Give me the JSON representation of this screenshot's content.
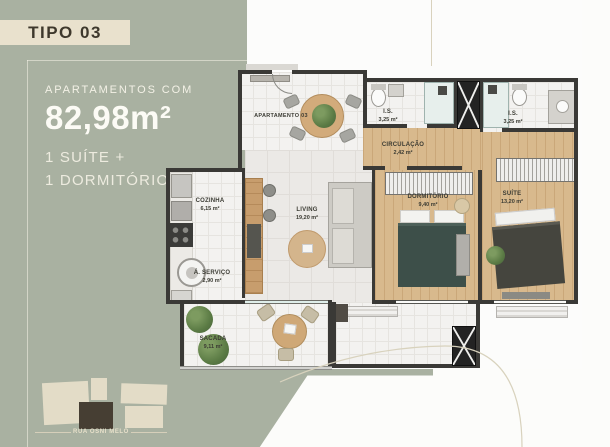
{
  "colors": {
    "background_green": "#a9b1a1",
    "band_cream": "#e9e1cd",
    "title_text": "#3e382c",
    "light_text": "#f3f1e6",
    "plan_wall": "#3a3936",
    "wood_floor": "#d8b98d",
    "keyplan_highlight": "#463e33"
  },
  "header": {
    "title": "TIPO 03"
  },
  "summary": {
    "prefix": "APARTAMENTOS COM",
    "area": "82,98m²",
    "line2": "1 SUÍTE +",
    "line3": "1 DORMITÓRIO"
  },
  "plan": {
    "unit_label": "APARTAMENTO 03",
    "rooms": [
      {
        "id": "cozinha",
        "name": "COZINHA",
        "area": "6,15 m²"
      },
      {
        "id": "a-servico",
        "name": "Á. SERVIÇO",
        "area": "2,90 m²"
      },
      {
        "id": "living",
        "name": "LIVING",
        "area": "19,20 m²"
      },
      {
        "id": "circulacao",
        "name": "CIRCULAÇÃO",
        "area": "2,42 m²"
      },
      {
        "id": "is-1",
        "name": "I.S.",
        "area": "3,25 m²"
      },
      {
        "id": "is-2",
        "name": "I.S.",
        "area": "3,25 m²"
      },
      {
        "id": "dormitorio",
        "name": "DORMITÓRIO",
        "area": "9,40 m²"
      },
      {
        "id": "suite",
        "name": "SUÍTE",
        "area": "13,20 m²"
      },
      {
        "id": "sacada",
        "name": "SACADA",
        "area": "9,11 m²"
      }
    ]
  },
  "keyplan": {
    "street": "RUA OSNI MELO"
  }
}
